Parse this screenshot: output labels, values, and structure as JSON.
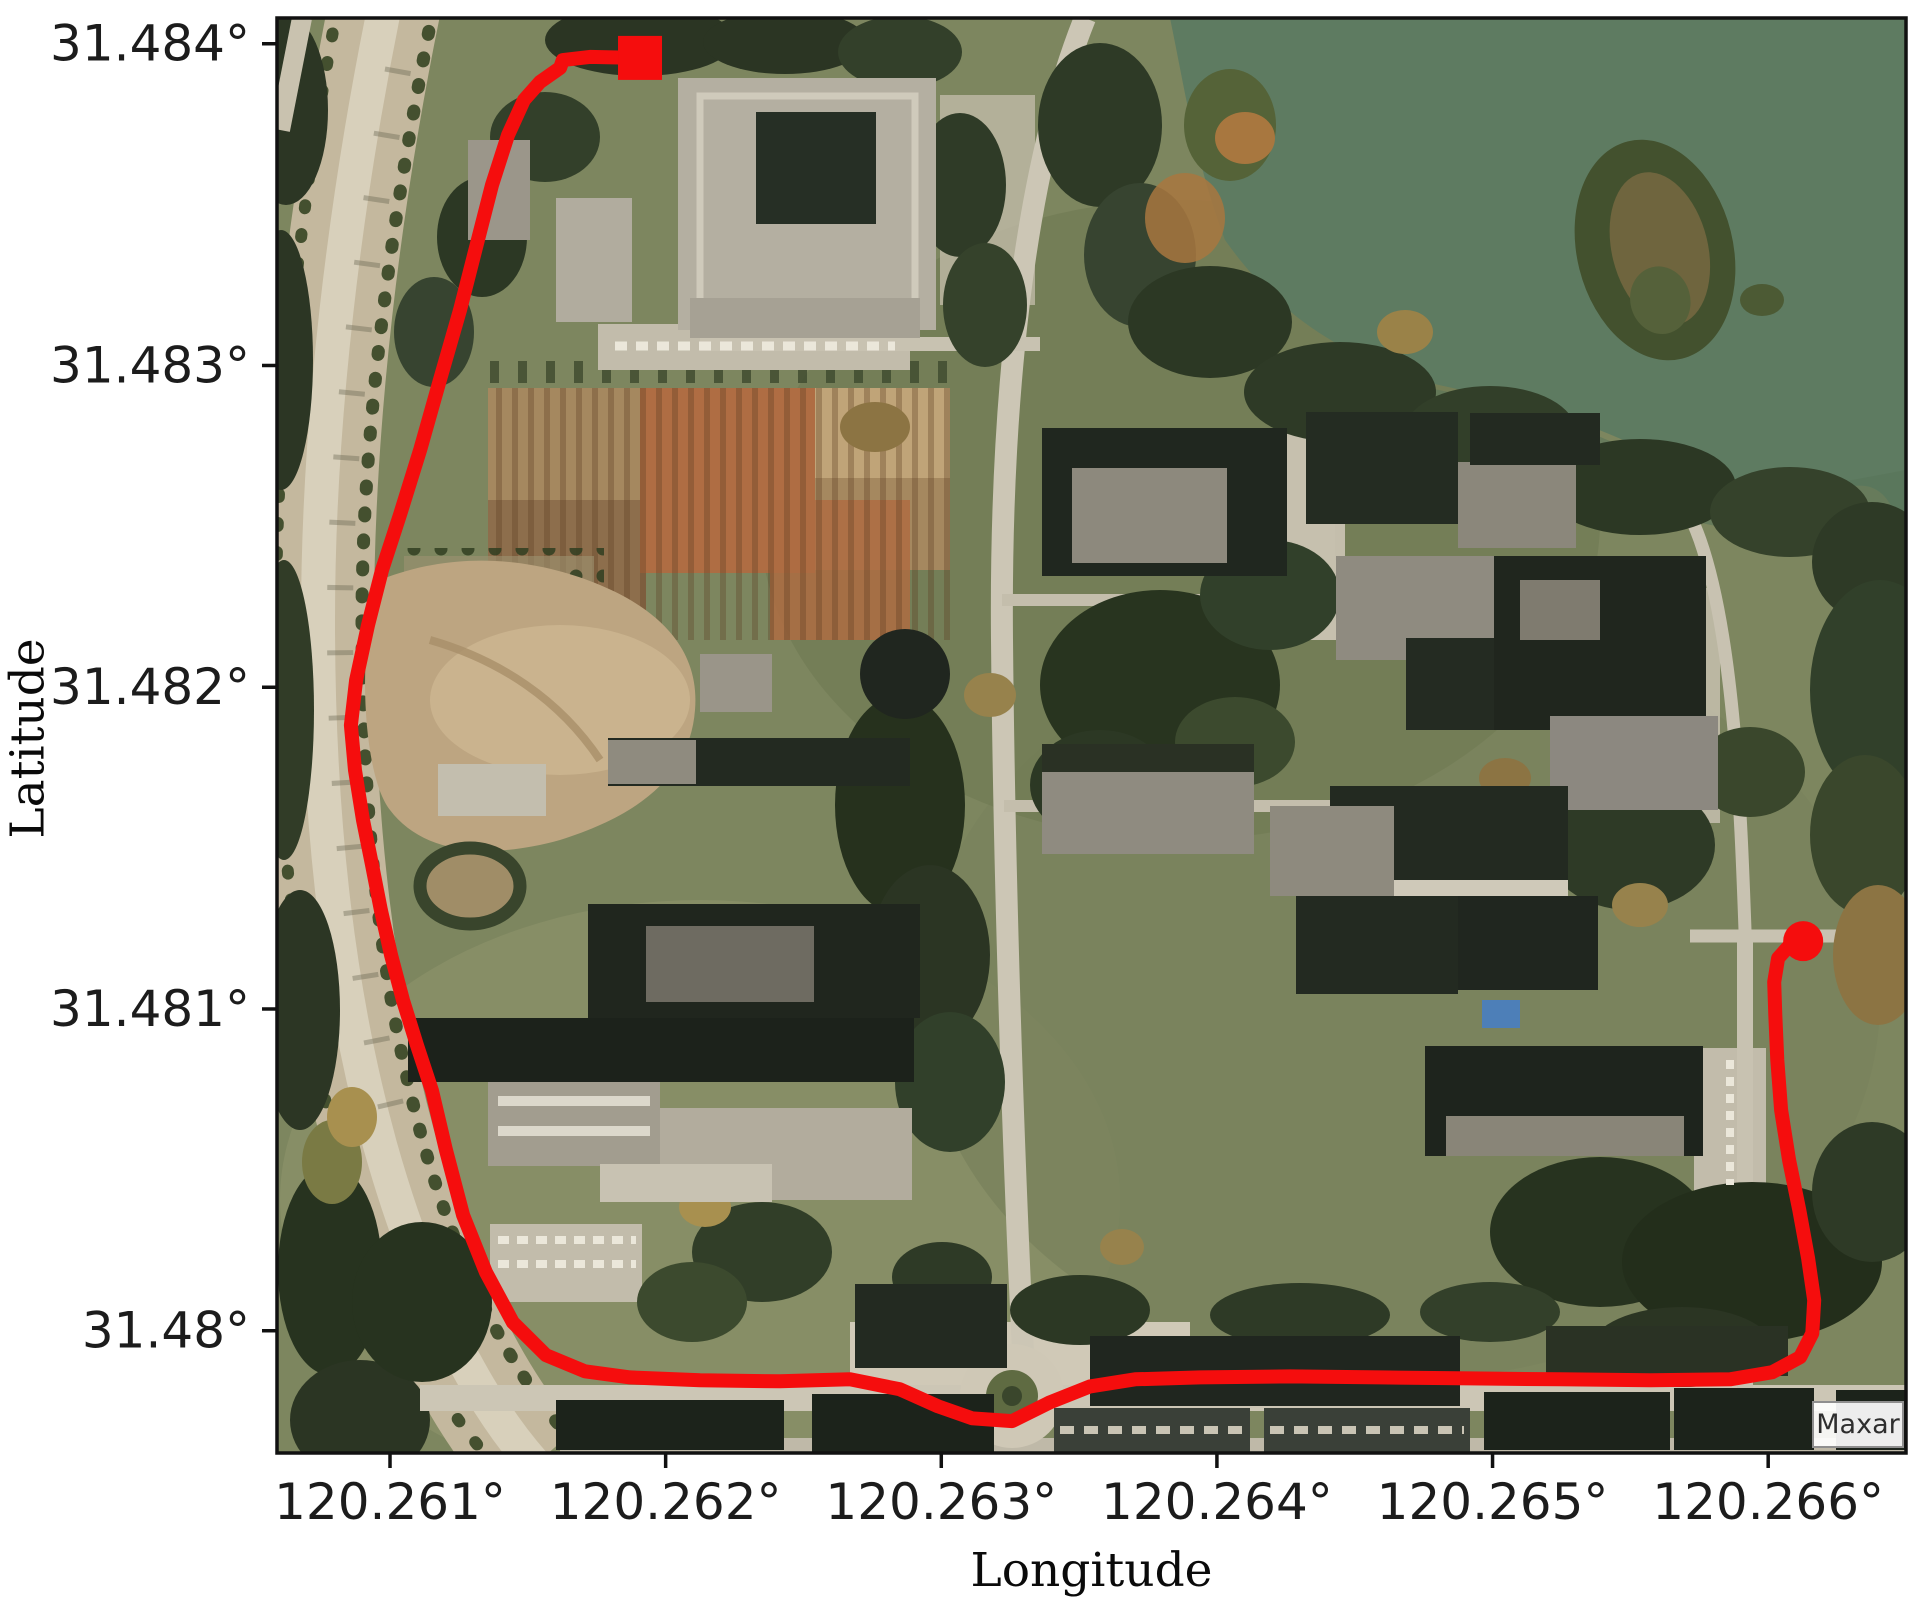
{
  "axes": {
    "xlabel": "Longitude",
    "ylabel": "Latitude",
    "x_tick_labels": [
      "120.261°",
      "120.262°",
      "120.263°",
      "120.264°",
      "120.265°",
      "120.266°"
    ],
    "y_tick_labels": [
      "31.48°",
      "31.481°",
      "31.482°",
      "31.483°",
      "31.484°"
    ]
  },
  "map": {
    "attribution": "Maxar",
    "imagery": "satellite",
    "accent_color": "#f50d0d"
  },
  "chart_data": {
    "type": "line",
    "title": "",
    "xlabel": "Longitude",
    "ylabel": "Latitude",
    "xlim": [
      120.26059,
      120.2665
    ],
    "ylim": [
      31.47962,
      31.48408
    ],
    "grid": false,
    "legend": "none",
    "x_ticks": {
      "values": [
        120.261,
        120.262,
        120.263,
        120.264,
        120.265,
        120.266
      ],
      "labels": [
        "120.261°",
        "120.262°",
        "120.263°",
        "120.264°",
        "120.265°",
        "120.266°"
      ]
    },
    "y_ticks": {
      "values": [
        31.48,
        31.481,
        31.482,
        31.483,
        31.484
      ],
      "labels": [
        "31.48°",
        "31.481°",
        "31.482°",
        "31.483°",
        "31.484°"
      ]
    },
    "series": [
      {
        "name": "GPS trajectory",
        "color": "#f50d0d",
        "linewidth": 14,
        "start_marker": "square",
        "end_marker": "circle",
        "points": [
          [
            120.261907,
            31.483956
          ],
          [
            120.261725,
            31.483959
          ],
          [
            120.261627,
            31.483949
          ],
          [
            120.261617,
            31.483925
          ],
          [
            120.261544,
            31.483881
          ],
          [
            120.261486,
            31.483825
          ],
          [
            120.261428,
            31.483716
          ],
          [
            120.26137,
            31.483561
          ],
          [
            120.261319,
            31.48339
          ],
          [
            120.261254,
            31.483172
          ],
          [
            120.261181,
            31.482955
          ],
          [
            120.261109,
            31.482737
          ],
          [
            120.261036,
            31.482535
          ],
          [
            120.260971,
            31.482364
          ],
          [
            120.26092,
            31.482193
          ],
          [
            120.260877,
            31.482022
          ],
          [
            120.260858,
            31.481882
          ],
          [
            120.260873,
            31.481742
          ],
          [
            120.260902,
            31.481587
          ],
          [
            120.260935,
            31.481447
          ],
          [
            120.260967,
            31.481307
          ],
          [
            120.261004,
            31.481167
          ],
          [
            120.261047,
            31.481027
          ],
          [
            120.261098,
            31.480887
          ],
          [
            120.261152,
            31.480747
          ],
          [
            120.261203,
            31.480561
          ],
          [
            120.261265,
            31.480359
          ],
          [
            120.261348,
            31.480182
          ],
          [
            120.261446,
            31.480026
          ],
          [
            120.261566,
            31.479924
          ],
          [
            120.261707,
            31.479874
          ],
          [
            120.261871,
            31.479855
          ],
          [
            120.262125,
            31.479846
          ],
          [
            120.262415,
            31.479843
          ],
          [
            120.262669,
            31.479849
          ],
          [
            120.26285,
            31.479818
          ],
          [
            120.262988,
            31.479765
          ],
          [
            120.263112,
            31.479728
          ],
          [
            120.263257,
            31.479719
          ],
          [
            120.263395,
            31.479778
          ],
          [
            120.26354,
            31.479827
          ],
          [
            120.263703,
            31.479849
          ],
          [
            120.263939,
            31.479855
          ],
          [
            120.264266,
            31.479858
          ],
          [
            120.264592,
            31.479855
          ],
          [
            120.264919,
            31.479852
          ],
          [
            120.265245,
            31.479849
          ],
          [
            120.265572,
            31.479846
          ],
          [
            120.265862,
            31.479849
          ],
          [
            120.266015,
            31.479871
          ],
          [
            120.266116,
            31.479918
          ],
          [
            120.26616,
            31.479992
          ],
          [
            120.266167,
            31.480095
          ],
          [
            120.266145,
            31.480225
          ],
          [
            120.266113,
            31.480375
          ],
          [
            120.266076,
            31.48053
          ],
          [
            120.266047,
            31.480686
          ],
          [
            120.266033,
            31.480841
          ],
          [
            120.266026,
            31.480981
          ],
          [
            120.266022,
            31.481084
          ],
          [
            120.266036,
            31.481158
          ],
          [
            120.266076,
            31.481196
          ],
          [
            120.266127,
            31.481211
          ]
        ]
      }
    ]
  }
}
